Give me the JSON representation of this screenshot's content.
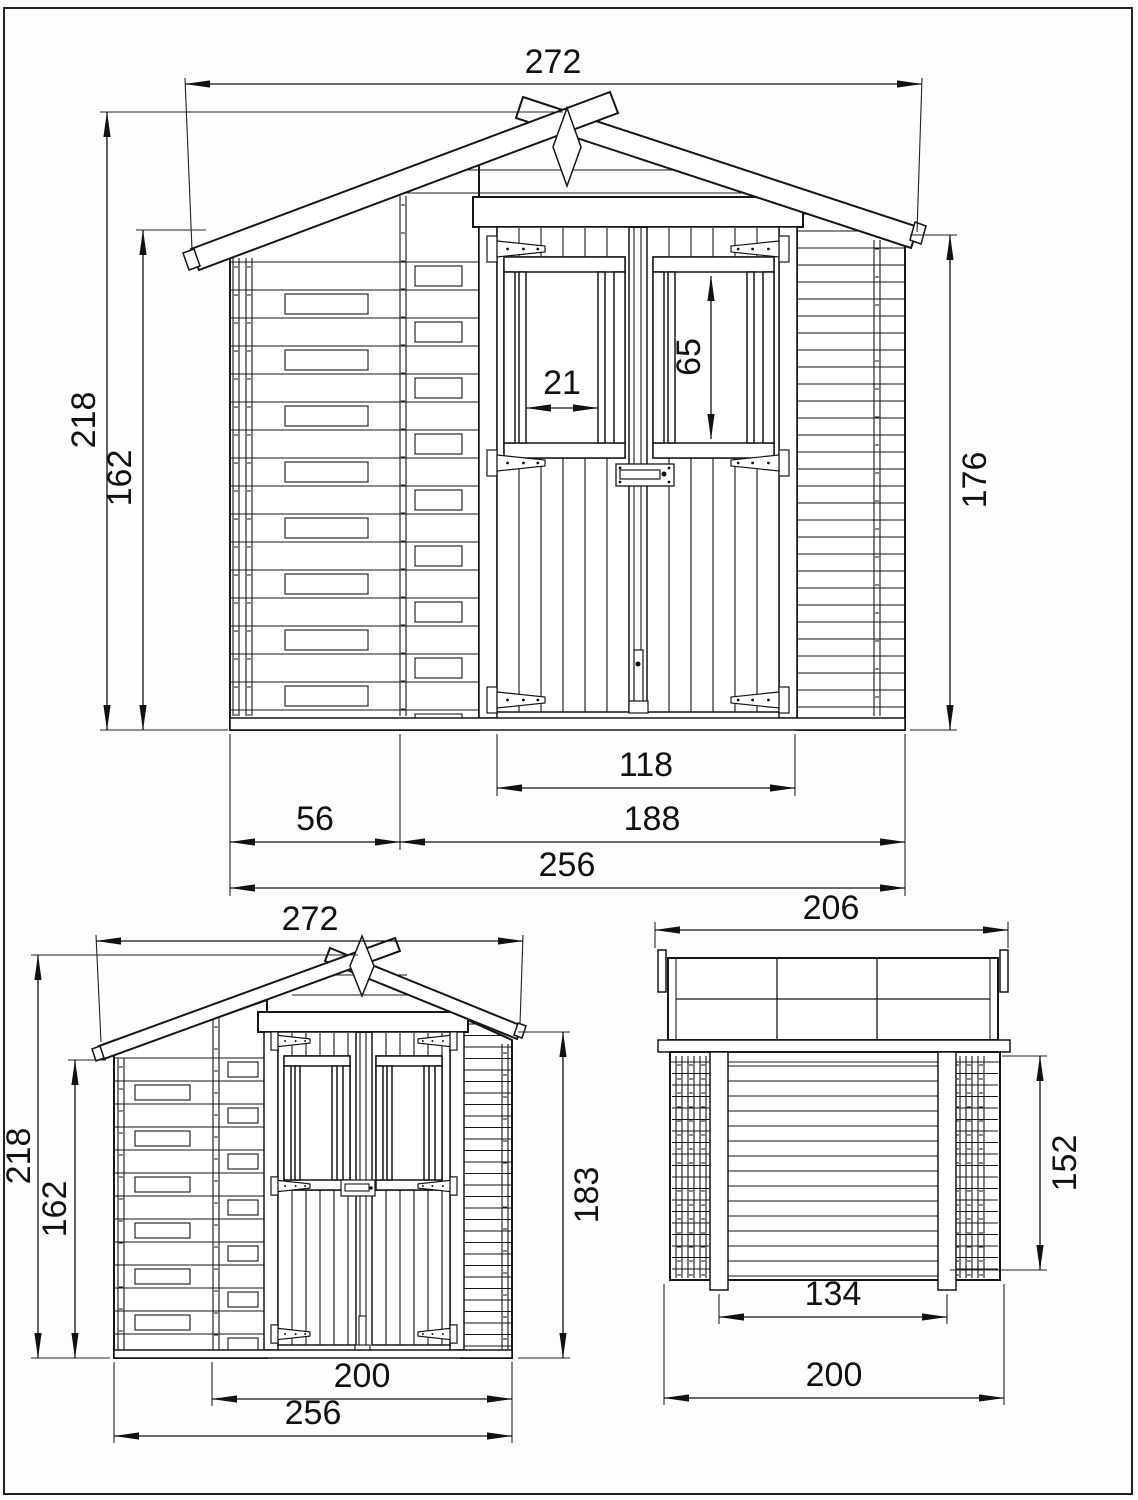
{
  "drawing": {
    "front": {
      "roof_width": "272",
      "total_height": "218",
      "wall_height": "162",
      "pane_width": "21",
      "window_height": "65",
      "side_height": "176",
      "door_width": "118",
      "left_section": "56",
      "door_section": "188",
      "base_width": "256"
    },
    "rear": {
      "roof_width": "272",
      "total_height": "218",
      "wall_height": "162",
      "side_height": "183",
      "door_section": "200",
      "base_width": "256"
    },
    "side": {
      "roof_depth": "206",
      "wall_height": "152",
      "inner_span": "134",
      "base_depth": "200"
    }
  }
}
